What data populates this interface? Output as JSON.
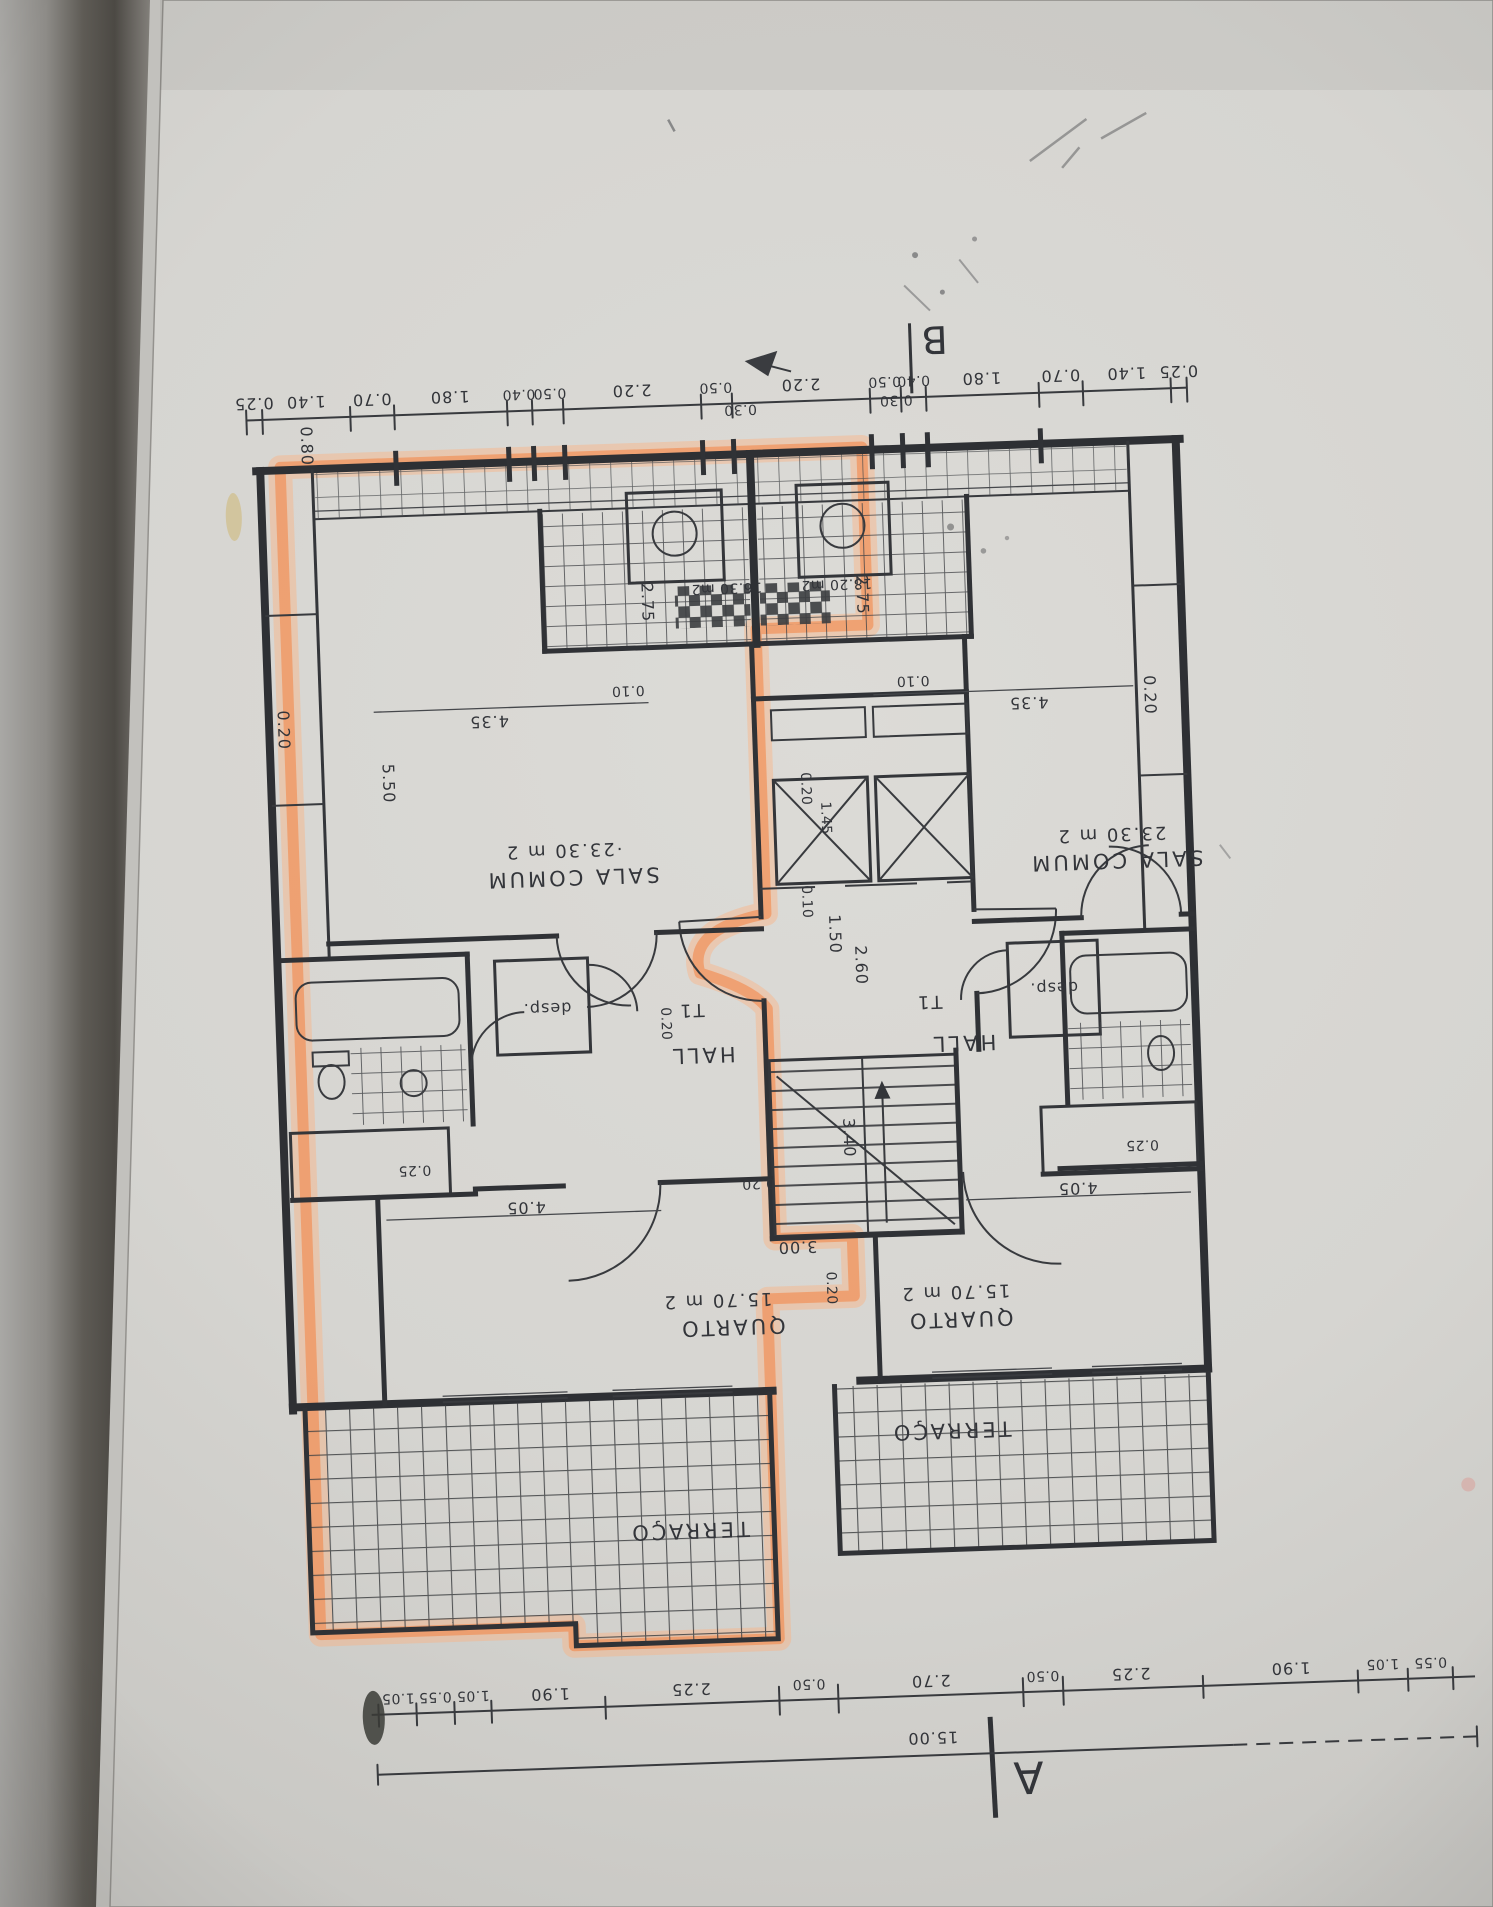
{
  "markers": {
    "section_a": "A",
    "section_b": "B"
  },
  "rooms": {
    "sala_name": "SALA COMUM",
    "sala_area_left": "·23.30 m 2",
    "sala_area_right": "23.30 m 2",
    "quarto_name": "QUARTO",
    "quarto_area": "15.70 m 2",
    "terraco_name": "TERRAÇO",
    "hall_name": "HALL",
    "desp_name": "desp.",
    "unit_type": "T1",
    "kitchen_area_left": "16.30 m2",
    "kitchen_area_right": "18.20 m2"
  },
  "dims": {
    "top_chain": [
      "0.25",
      "1.40",
      "0.70",
      "1.80",
      "0.40",
      "0.50",
      "2.20",
      "0.50",
      "2.20",
      "0.50",
      "0.40",
      "1.80",
      "0.70",
      "1.40",
      "0.25"
    ],
    "bottom_chain": [
      "1.05",
      "0.55",
      "1.05",
      "1.90",
      "2.25",
      "0.50",
      "2.70",
      "0.50",
      "2.25",
      "1.90",
      "1.05",
      "0.55"
    ],
    "bottom_total": "15.00",
    "w435": "4.35",
    "g010": "0.10",
    "v080": "0.80",
    "v550": "5.50",
    "v020": "0.20",
    "v275": "2.75",
    "t030": "0.30",
    "e020": "0.20",
    "e145": "1.45",
    "e010": "0.10",
    "e150": "1.50",
    "e260": "2.60",
    "h020": "0.20",
    "s340": "3.40",
    "s020": "0.20",
    "s300": "3.00",
    "q405": "4.05",
    "q025": "0.25",
    "q020": "0.20"
  }
}
